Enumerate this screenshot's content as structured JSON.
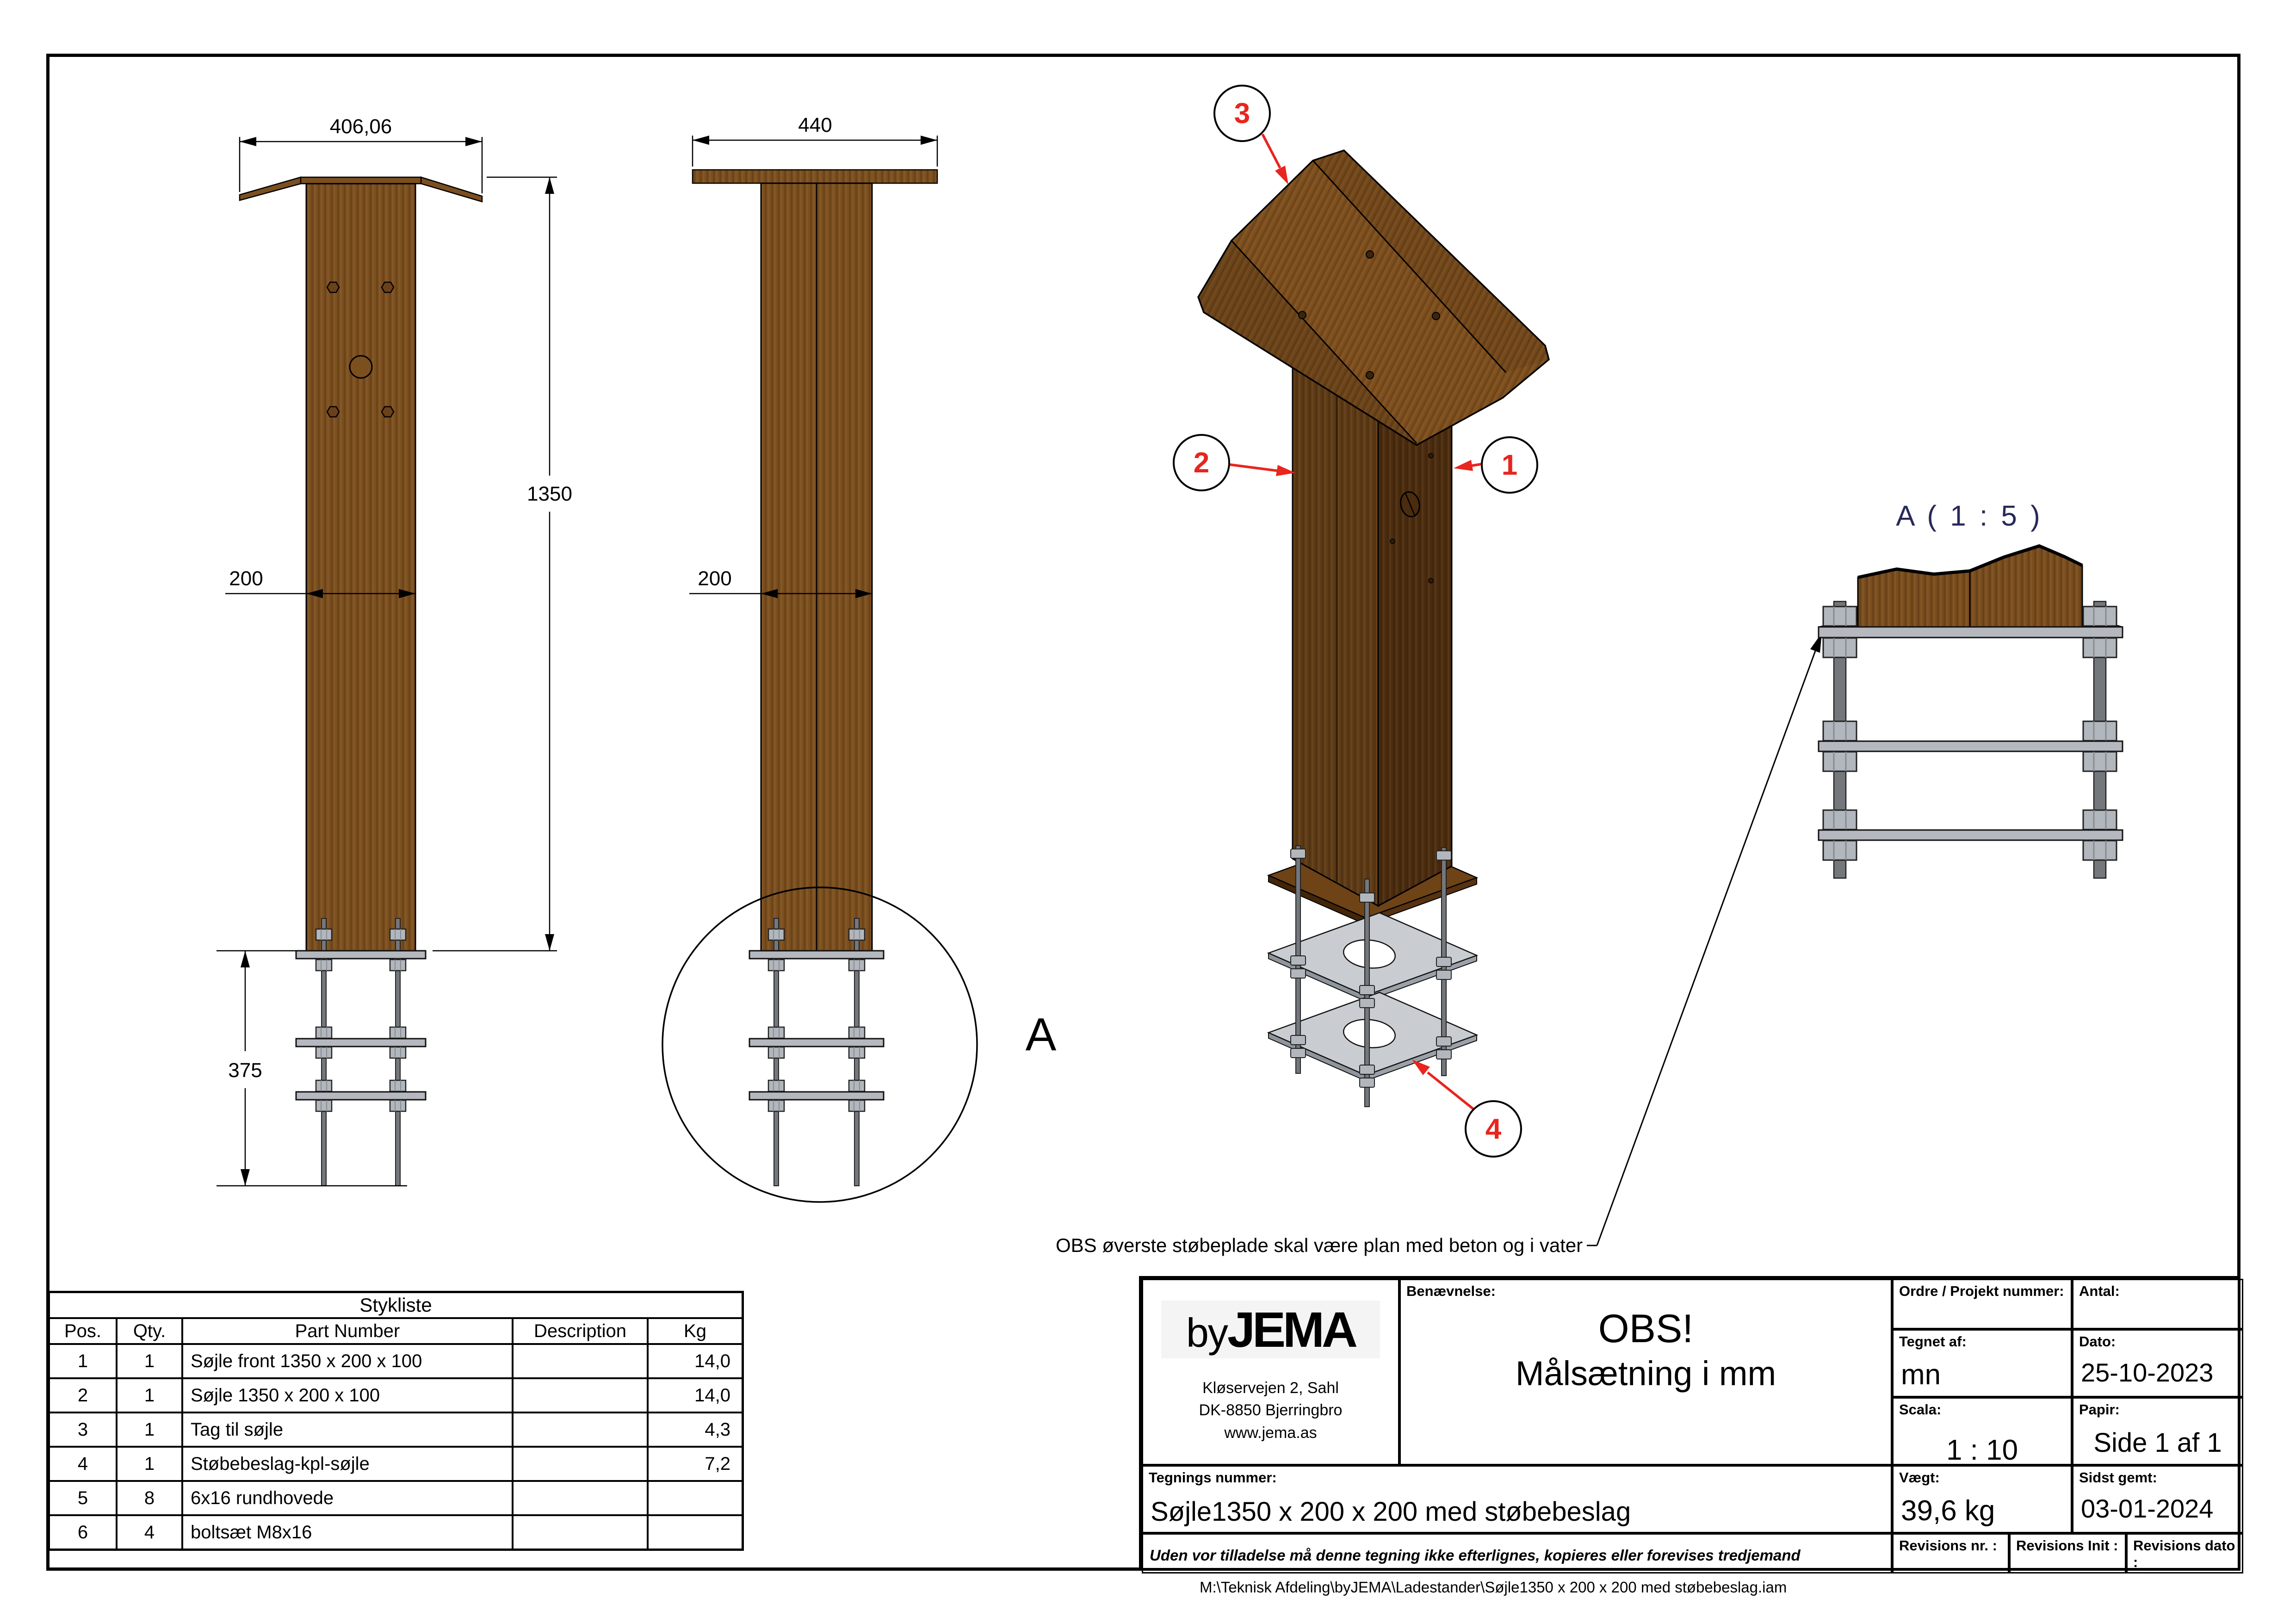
{
  "front_view": {
    "dim_top": "406,06",
    "dim_width": "200",
    "dim_height": "1350",
    "dim_anchor": "375"
  },
  "side_view": {
    "dim_top": "440",
    "dim_width": "200",
    "detail_label": "A"
  },
  "detail_view": {
    "title": "A ( 1 : 5 )"
  },
  "iso_view": {
    "balloon_1": "1",
    "balloon_2": "2",
    "balloon_3": "3",
    "balloon_4": "4",
    "note": "OBS øverste støbeplade skal være plan med beton og i vater"
  },
  "parts_table": {
    "title": "Stykliste",
    "columns": {
      "pos": "Pos.",
      "qty": "Qty.",
      "part": "Part Number",
      "desc": "Description",
      "kg": "Kg"
    },
    "rows": [
      {
        "pos": "1",
        "qty": "1",
        "part": "Søjle front 1350 x 200 x 100",
        "desc": "",
        "kg": "14,0"
      },
      {
        "pos": "2",
        "qty": "1",
        "part": "Søjle 1350 x 200 x 100",
        "desc": "",
        "kg": "14,0"
      },
      {
        "pos": "3",
        "qty": "1",
        "part": "Tag til søjle",
        "desc": "",
        "kg": "4,3"
      },
      {
        "pos": "4",
        "qty": "1",
        "part": "Støbebeslag-kpl-søjle",
        "desc": "",
        "kg": "7,2"
      },
      {
        "pos": "5",
        "qty": "8",
        "part": "6x16 rundhovede",
        "desc": "",
        "kg": ""
      },
      {
        "pos": "6",
        "qty": "4",
        "part": "boltsæt M8x16",
        "desc": "",
        "kg": ""
      }
    ]
  },
  "title_block": {
    "logo_by": "by",
    "logo_name": "JEMA",
    "address_1": "Kløservejen 2, Sahl",
    "address_2": "DK-8850 Bjerringbro",
    "address_3": "www.jema.as",
    "benaevnelse_label": "Benævnelse:",
    "benaevnelse_line1": "OBS!",
    "benaevnelse_line2": "Målsætning i mm",
    "ordre_label": "Ordre / Projekt nummer:",
    "antal_label": "Antal:",
    "tegnet_label": "Tegnet af:",
    "tegnet_value": "mn",
    "dato_label": "Dato:",
    "dato_value": "25-10-2023",
    "scala_label": "Scala:",
    "scala_value": "1 : 10",
    "papir_label": "Papir:",
    "papir_value": "Side 1 af 1",
    "tegnings_label": "Tegnings nummer:",
    "tegnings_value": "Søjle1350 x 200 x 200 med støbebeslag",
    "vaegt_label": "Vægt:",
    "vaegt_value": "39,6 kg",
    "sidst_label": "Sidst gemt:",
    "sidst_value": "03-01-2024",
    "rev_nr_label": "Revisions nr. :",
    "rev_init_label": "Revisions Init :",
    "rev_dato_label": "Revisions dato :",
    "disclaimer": "Uden vor tilladelse må denne tegning ikke efterlignes, kopieres eller forevises tredjemand"
  },
  "footer_path": "M:\\Teknisk Afdeling\\byJEMA\\Ladestander\\Søjle1350 x 200 x 200 med støbebeslag.iam",
  "colors": {
    "wood": "#7c4f1f",
    "wood_dark": "#4b2c0f",
    "plate_gray": "#b5b9bf",
    "accent_red": "#e8251e",
    "detail_navy": "#28285a"
  }
}
